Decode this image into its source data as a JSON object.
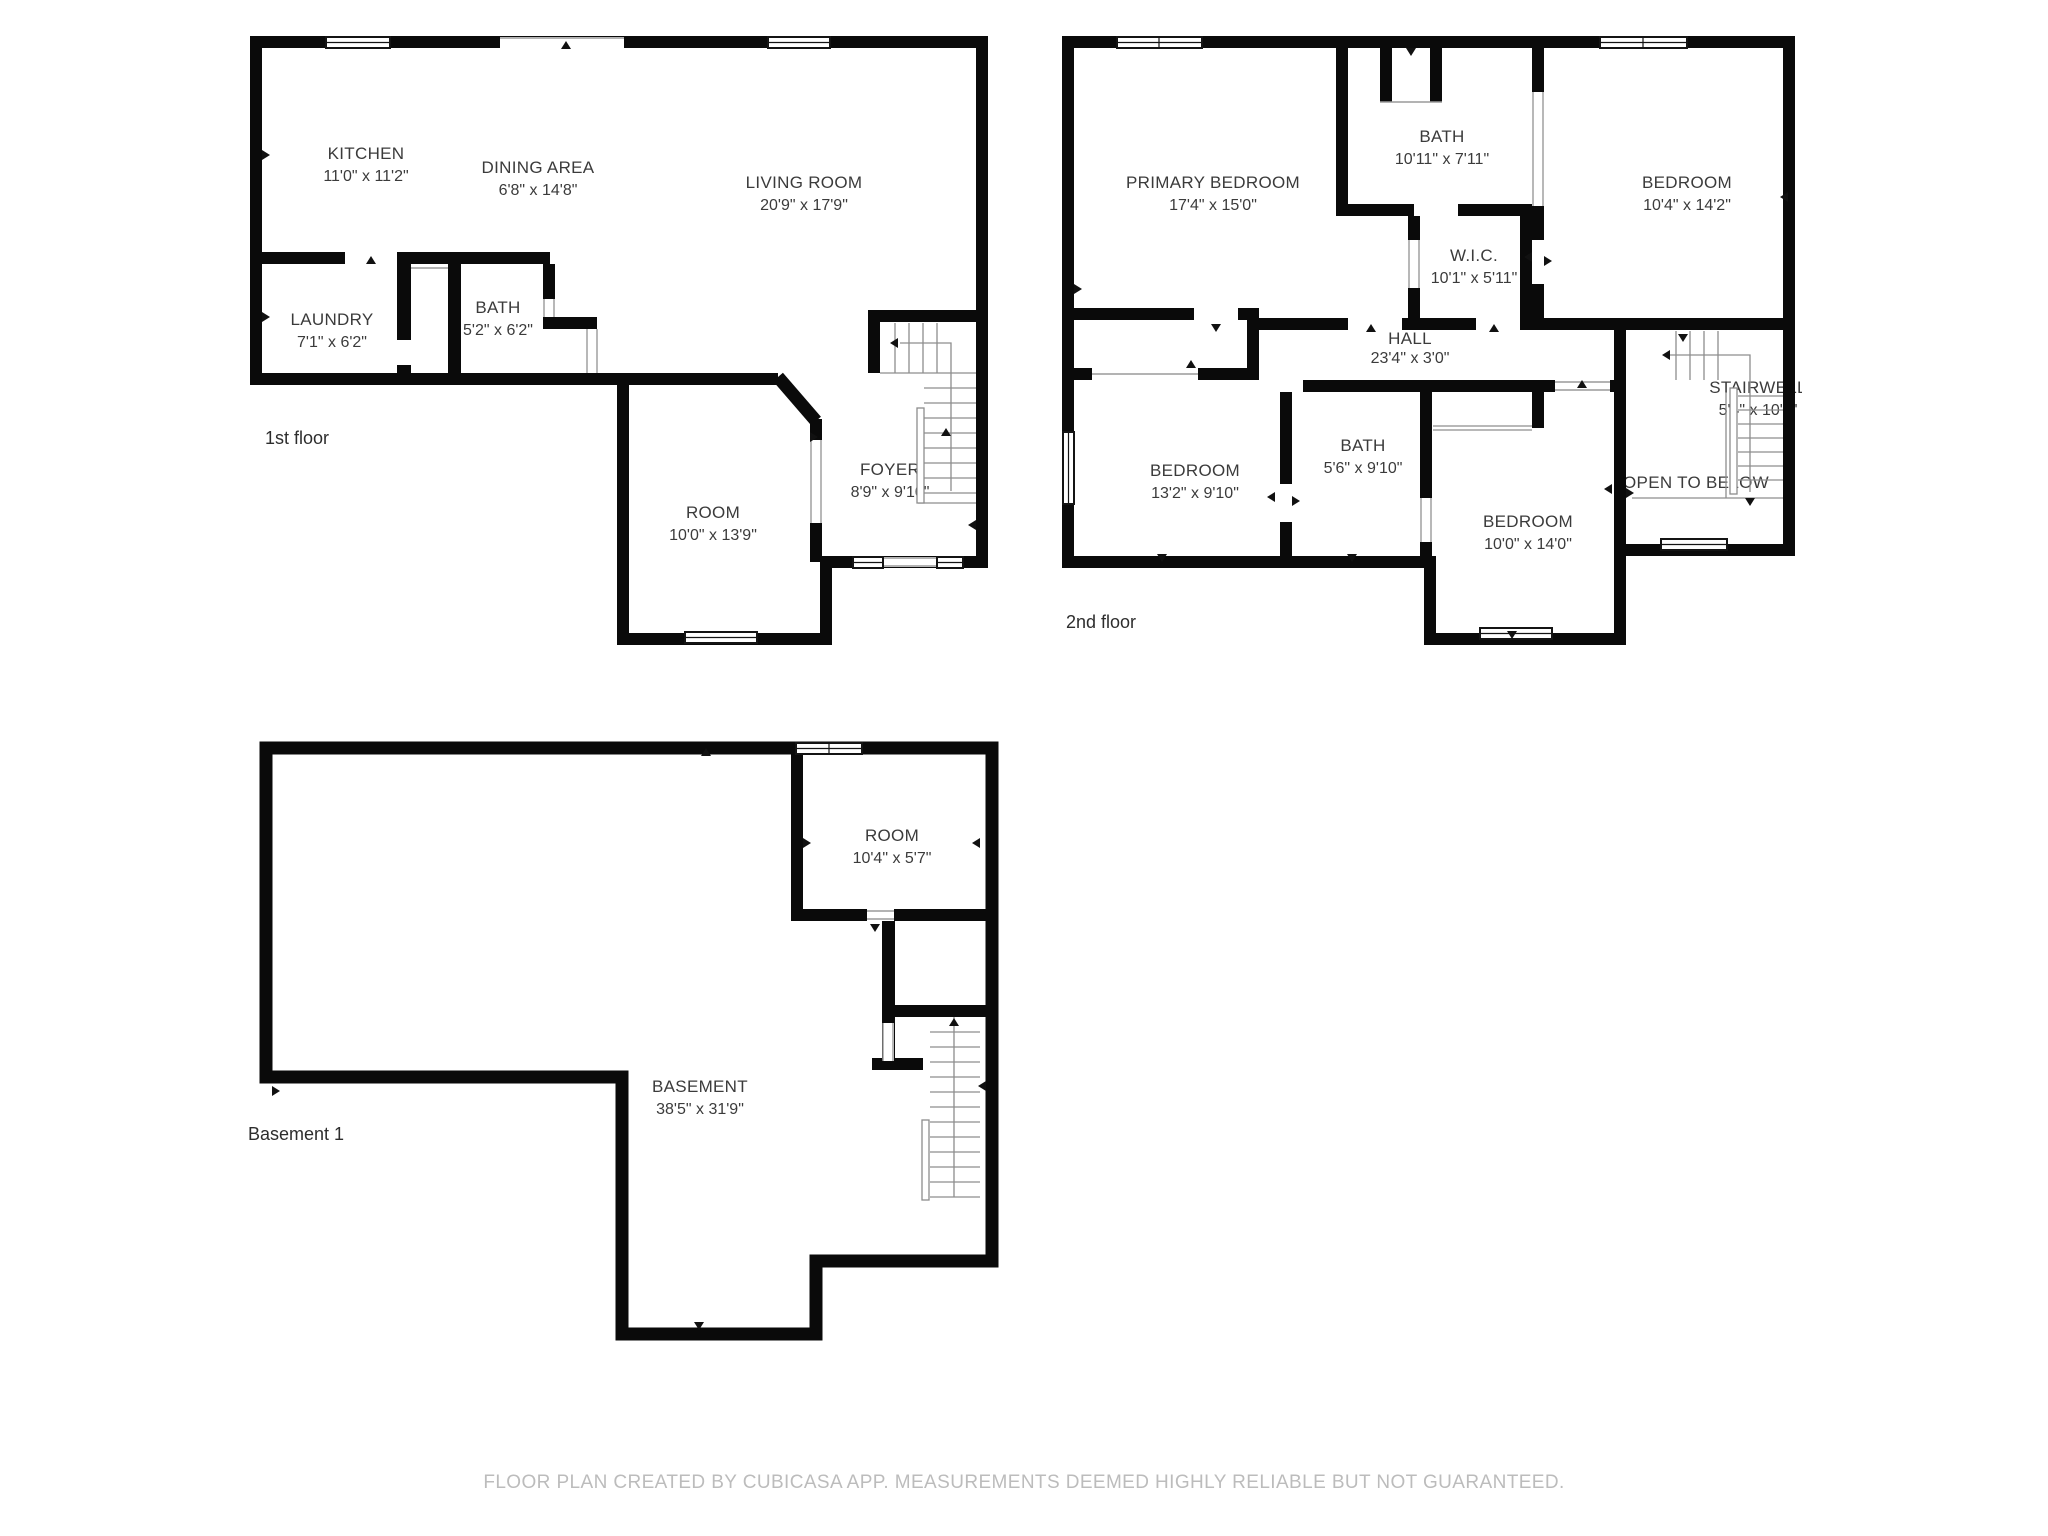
{
  "meta": {
    "app_footer": "FLOOR PLAN CREATED BY CUBICASA APP. MEASUREMENTS DEEMED HIGHLY RELIABLE BUT NOT GUARANTEED."
  },
  "colors": {
    "background": "#ffffff",
    "wall": "#0a0a0a",
    "room_text": "#3b3b3b",
    "floor_label_text": "#2d2d2d",
    "stair_line": "#8d8d8d",
    "opening_line": "#9a9a9a",
    "footer_text": "#bcbcbc"
  },
  "floors": [
    {
      "label": "1st floor",
      "rooms": [
        {
          "name": "KITCHEN",
          "dims": "11'0\" x 11'2\""
        },
        {
          "name": "DINING AREA",
          "dims": "6'8\" x 14'8\""
        },
        {
          "name": "LIVING ROOM",
          "dims": "20'9\" x 17'9\""
        },
        {
          "name": "LAUNDRY",
          "dims": "7'1\" x 6'2\""
        },
        {
          "name": "BATH",
          "dims": "5'2\" x 6'2\""
        },
        {
          "name": "ROOM",
          "dims": "10'0\" x 13'9\""
        },
        {
          "name": "FOYER",
          "dims": "8'9\" x 9'10\""
        }
      ]
    },
    {
      "label": "2nd floor",
      "rooms": [
        {
          "name": "PRIMARY BEDROOM",
          "dims": "17'4\" x 15'0\""
        },
        {
          "name": "BATH",
          "dims": "10'11\" x 7'11\""
        },
        {
          "name": "BEDROOM",
          "dims": "10'4\" x 14'2\""
        },
        {
          "name": "W.I.C.",
          "dims": "10'1\" x 5'11\""
        },
        {
          "name": "HALL",
          "dims": "23'4\" x 3'0\""
        },
        {
          "name": "BEDROOM",
          "dims": "13'2\" x 9'10\""
        },
        {
          "name": "BATH",
          "dims": "5'6\" x 9'10\""
        },
        {
          "name": "BEDROOM",
          "dims": "10'0\" x 14'0\""
        },
        {
          "name": "STAIRWELL",
          "dims": "5'4\" x 10'1\""
        },
        {
          "name": "OPEN TO BELOW",
          "dims": ""
        }
      ]
    },
    {
      "label": "Basement 1",
      "rooms": [
        {
          "name": "ROOM",
          "dims": "10'4\" x 5'7\""
        },
        {
          "name": "BASEMENT",
          "dims": "38'5\" x 31'9\""
        }
      ]
    }
  ]
}
